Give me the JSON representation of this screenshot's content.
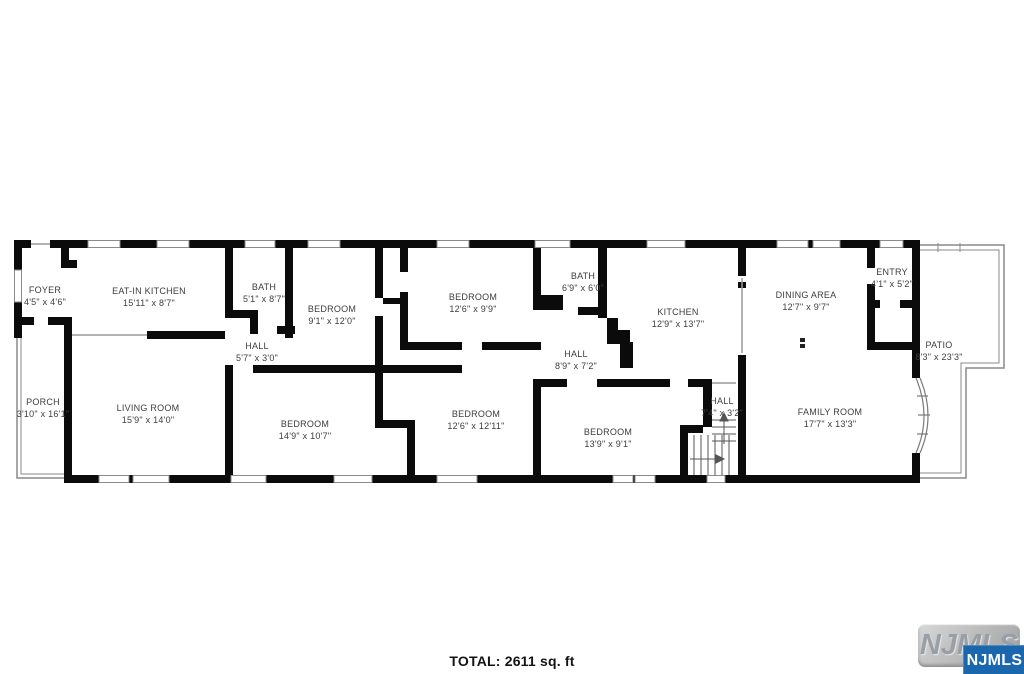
{
  "floorplan": {
    "rooms": [
      {
        "id": "foyer",
        "name": "FOYER",
        "dims": "4'5\" x 4'6\""
      },
      {
        "id": "eat_in_kitchen",
        "name": "EAT-IN KITCHEN",
        "dims": "15'11\" x 8'7\""
      },
      {
        "id": "bath_1",
        "name": "BATH",
        "dims": "5'1\" x 8'7\""
      },
      {
        "id": "hall_1",
        "name": "HALL",
        "dims": "5'7\" x 3'0\""
      },
      {
        "id": "bedroom_1",
        "name": "BEDROOM",
        "dims": "9'1\" x 12'0\""
      },
      {
        "id": "porch",
        "name": "PORCH",
        "dims": "3'10\" x 16'1\""
      },
      {
        "id": "living_room",
        "name": "LIVING ROOM",
        "dims": "15'9\" x 14'0\""
      },
      {
        "id": "bedroom_2",
        "name": "BEDROOM",
        "dims": "12'6\" x 9'9\""
      },
      {
        "id": "bedroom_3",
        "name": "BEDROOM",
        "dims": "14'9\" x 10'7\""
      },
      {
        "id": "bedroom_4",
        "name": "BEDROOM",
        "dims": "12'6\" x 12'11\""
      },
      {
        "id": "bath_2",
        "name": "BATH",
        "dims": "6'9\" x 6'0\""
      },
      {
        "id": "hall_2",
        "name": "HALL",
        "dims": "8'9\" x 7'2\""
      },
      {
        "id": "bedroom_5",
        "name": "BEDROOM",
        "dims": "13'9\" x 9'1\""
      },
      {
        "id": "kitchen",
        "name": "KITCHEN",
        "dims": "12'9\" x 13'7\""
      },
      {
        "id": "hall_3",
        "name": "HALL",
        "dims": "7'4\" x 3'2\""
      },
      {
        "id": "dining_area",
        "name": "DINING AREA",
        "dims": "12'7\" x 9'7\""
      },
      {
        "id": "family_room",
        "name": "FAMILY ROOM",
        "dims": "17'7\" x 13'3\""
      },
      {
        "id": "entry",
        "name": "ENTRY",
        "dims": "4'1\" x 5'2\""
      },
      {
        "id": "patio",
        "name": "PATIO",
        "dims": "8'3\" x 23'3\""
      }
    ],
    "total_label": "TOTAL: 2611 sq. ft"
  },
  "watermark": {
    "embossed_text": "NJMLS",
    "badge_text": "NJMLS"
  },
  "colors": {
    "wall": "#0b0b0b",
    "thin_line": "#8a8a8a",
    "badge_blue": "#1a67ae"
  }
}
